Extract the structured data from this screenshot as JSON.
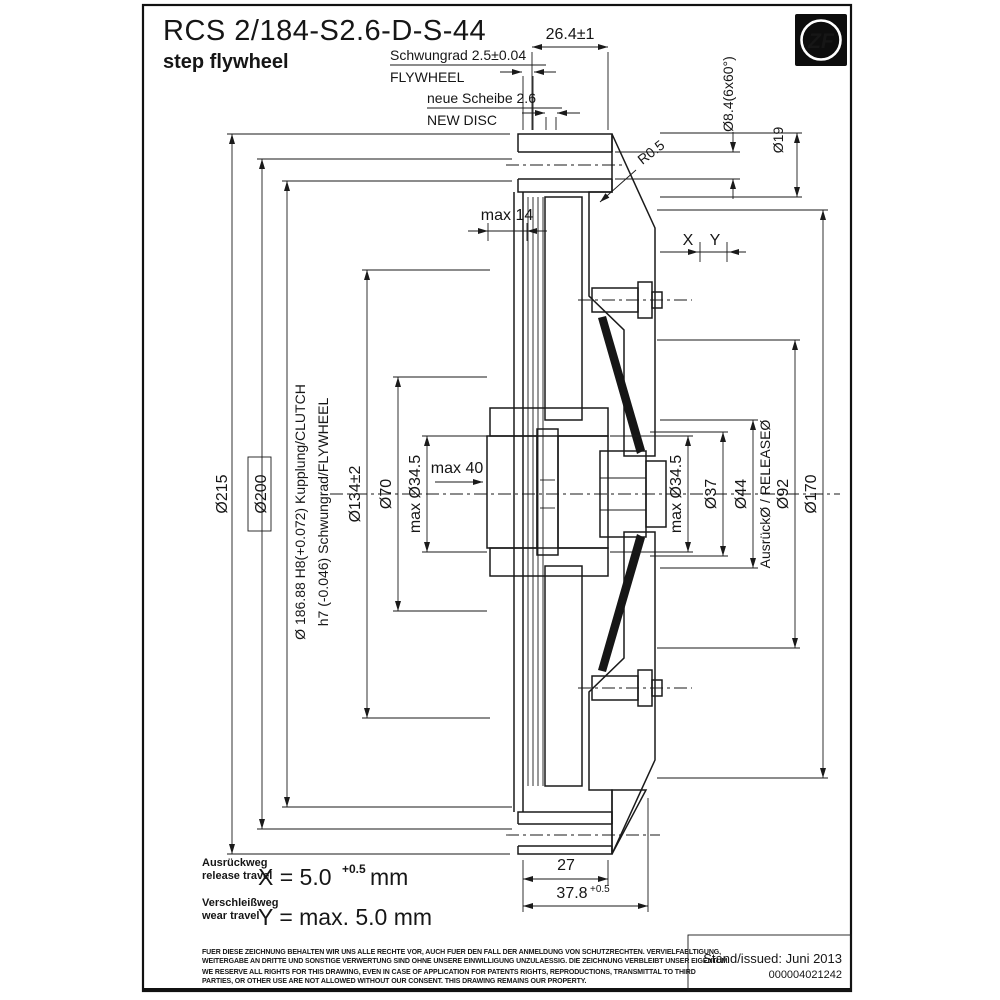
{
  "title": {
    "model": "RCS 2/184-S2.6-D-S-44",
    "subtitle": "step flywheel"
  },
  "logo": {
    "text": "ZF"
  },
  "top": {
    "flywheel_de": "Schwungrad 2.5±0.04",
    "flywheel_en": "FLYWHEEL",
    "disc_de": "neue Scheibe 2.6",
    "disc_en": "NEW DISC",
    "width_dim": "26.4±1",
    "bolt_holes": "Ø8.4(6x60°)",
    "boss_dia": "Ø19",
    "fillet": "R0.5",
    "max14": "max 14",
    "x_label": "X",
    "y_label": "Y"
  },
  "left": {
    "d215": "Ø215",
    "d200": "Ø200",
    "d186_fit": "Ø 186.88 H8(+0.072)  Kupplung/CLUTCH",
    "h7_fit": "h7 (-0.046)  Schwungrad/FLYWHEEL",
    "d134": "Ø134±2",
    "d70": "Ø70",
    "d345": "max  Ø34.5",
    "max40": "max  40"
  },
  "right": {
    "d345": "max  Ø34.5",
    "d37": "Ø37",
    "d44": "Ø44",
    "release": "AusrückØ  /  RELEASEØ",
    "d92": "Ø92",
    "d170": "Ø170"
  },
  "bottom": {
    "hub_len": "27",
    "total_len": "37.8",
    "total_tol": "+0.5"
  },
  "travel": {
    "release_de": "Ausrückweg",
    "release_en": "release travel",
    "release_val": "X = 5.0",
    "release_tol": "+0.5",
    "release_unit": "mm",
    "wear_de": "Verschleißweg",
    "wear_en": "wear travel",
    "wear_val": "Y = max. 5.0 mm"
  },
  "footer": {
    "de1": "FUER DIESE ZEICHNUNG BEHALTEN WIR UNS ALLE RECHTE VOR, AUCH FUER DEN FALL DER ANMELDUNG VON SCHUTZRECHTEN. VERVIELFAELTIGUNG,",
    "de2": "WEITERGABE AN DRITTE UND SONSTIGE VERWERTUNG SIND OHNE UNSERE EINWILLIGUNG UNZULAESSIG. DIE ZEICHNUNG VERBLEIBT UNSER EIGENTUM.",
    "en1": "WE RESERVE ALL RIGHTS FOR THIS DRAWING, EVEN IN CASE OF APPLICATION FOR PATENTS RIGHTS, REPRODUCTIONS, TRANSMITTAL TO THIRD",
    "en2": "PARTIES, OR OTHER USE ARE NOT ALLOWED WITHOUT OUR CONSENT. THIS DRAWING REMAINS OUR PROPERTY.",
    "issued": "Stand/issued: Juni 2013",
    "number": "000004021242"
  }
}
